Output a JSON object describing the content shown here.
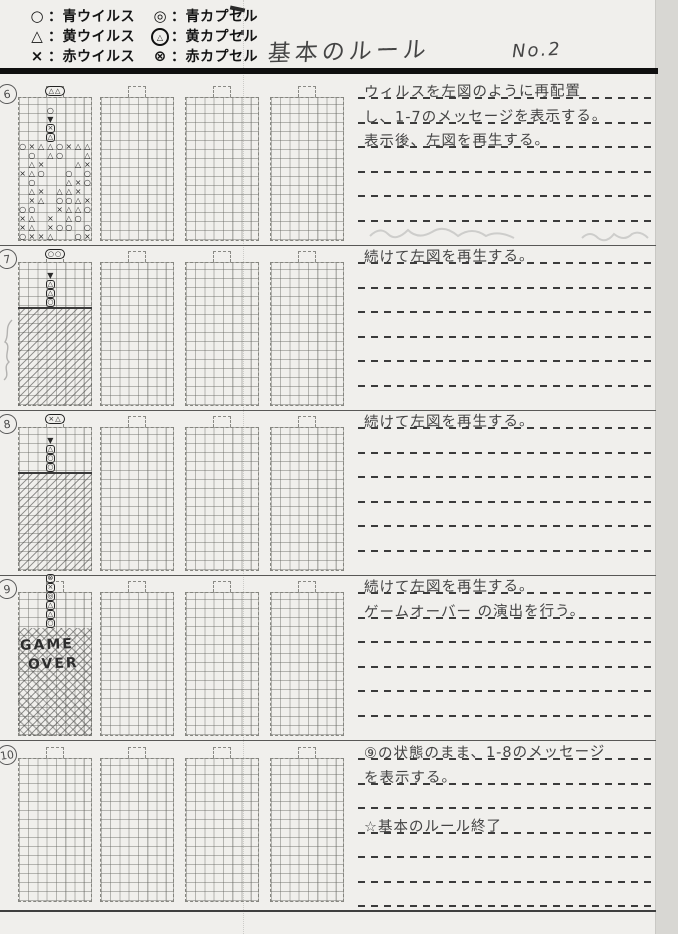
{
  "header": {
    "title": "基本のルール",
    "page_no": "No.2"
  },
  "legend": {
    "rows": [
      {
        "sym1": "O",
        "label1": "：青ウイルス",
        "sym2": "@O",
        "label2": "：青カプセル"
      },
      {
        "sym1": "A",
        "label1": "：黄ウイルス",
        "sym2": "@A",
        "label2": "：黄カプセル"
      },
      {
        "sym1": "X",
        "label1": "：赤ウイルス",
        "sym2": "@X",
        "label2": "：赤カプセル"
      }
    ]
  },
  "symbol_map": {
    "O": "○",
    "X": "×",
    "A": "△",
    "@O": "◎",
    "@X": "⊗",
    "arrow": "▼"
  },
  "sections": [
    {
      "number": "6",
      "panels": [
        {
          "type": "play",
          "neck_capsule": [
            "A",
            "A"
          ],
          "fall": [
            {
              "r": 1,
              "c": 3,
              "s": "O"
            },
            {
              "r": 2,
              "c": 3,
              "s": "arrow"
            },
            {
              "r": 3,
              "c": 3,
              "s": "X",
              "box": 1
            },
            {
              "r": 4,
              "c": 3,
              "s": "A",
              "box": 1
            }
          ],
          "field": [
            "OXAAOXAA",
            ".O.AO..A",
            ".AX...AX",
            "XAO..O.O",
            ".O...AXO",
            ".AX.AAX.",
            ".XA.OOAX",
            "OO..XAAO",
            "XA.X.AO.",
            "XA.XOO.O",
            "OXXA..OX"
          ]
        },
        {
          "type": "empty"
        },
        {
          "type": "empty"
        },
        {
          "type": "empty"
        }
      ],
      "notes": [
        "ウィルスを左図のように再配置",
        "し、1-7のメッセージを表示する。",
        "表示後、左図を再生する。"
      ],
      "line_count": 6
    },
    {
      "number": "7",
      "panels": [
        {
          "type": "hatch",
          "top_capsule": [
            "O",
            "O"
          ],
          "fall": [
            {
              "r": 1,
              "c": 3,
              "s": "arrow"
            },
            {
              "r": 2,
              "c": 3,
              "s": "A",
              "box": 1
            },
            {
              "r": 3,
              "c": 3,
              "s": "A",
              "box": 1
            },
            {
              "r": 4,
              "c": 3,
              "s": "O",
              "box": 1
            }
          ],
          "hatch_from": 5
        },
        {
          "type": "empty"
        },
        {
          "type": "empty"
        },
        {
          "type": "empty"
        }
      ],
      "notes": [
        "続けて左図を再生する。"
      ],
      "line_count": 6
    },
    {
      "number": "8",
      "panels": [
        {
          "type": "hatch",
          "top_capsule": [
            "X",
            "A"
          ],
          "fall": [
            {
              "r": 1,
              "c": 3,
              "s": "arrow"
            },
            {
              "r": 2,
              "c": 3,
              "s": "A",
              "box": 1
            },
            {
              "r": 3,
              "c": 3,
              "s": "O",
              "box": 1
            },
            {
              "r": 4,
              "c": 3,
              "s": "O",
              "box": 1
            }
          ],
          "hatch_from": 5
        },
        {
          "type": "empty"
        },
        {
          "type": "empty"
        },
        {
          "type": "empty"
        }
      ],
      "notes": [
        "続けて左図を再生する。"
      ],
      "line_count": 6
    },
    {
      "number": "9",
      "panels": [
        {
          "type": "gameover",
          "stack": [
            "@X",
            "X",
            "@O",
            "A",
            "A",
            "O"
          ],
          "overlay": [
            "GAME",
            "OVER"
          ],
          "hatch_from": 4
        },
        {
          "type": "empty"
        },
        {
          "type": "empty"
        },
        {
          "type": "empty"
        }
      ],
      "notes": [
        "続けて左図を再生する。",
        "ゲームオーバー の演出を行う。"
      ],
      "line_count": 6
    },
    {
      "number": "10",
      "panels": [
        {
          "type": "empty"
        },
        {
          "type": "empty"
        },
        {
          "type": "empty"
        },
        {
          "type": "empty"
        }
      ],
      "notes": [
        "⑨の状態のまま、1-8のメッセージ",
        "を表示する。",
        "",
        "☆基本のルール終了"
      ],
      "line_count": 7
    }
  ]
}
